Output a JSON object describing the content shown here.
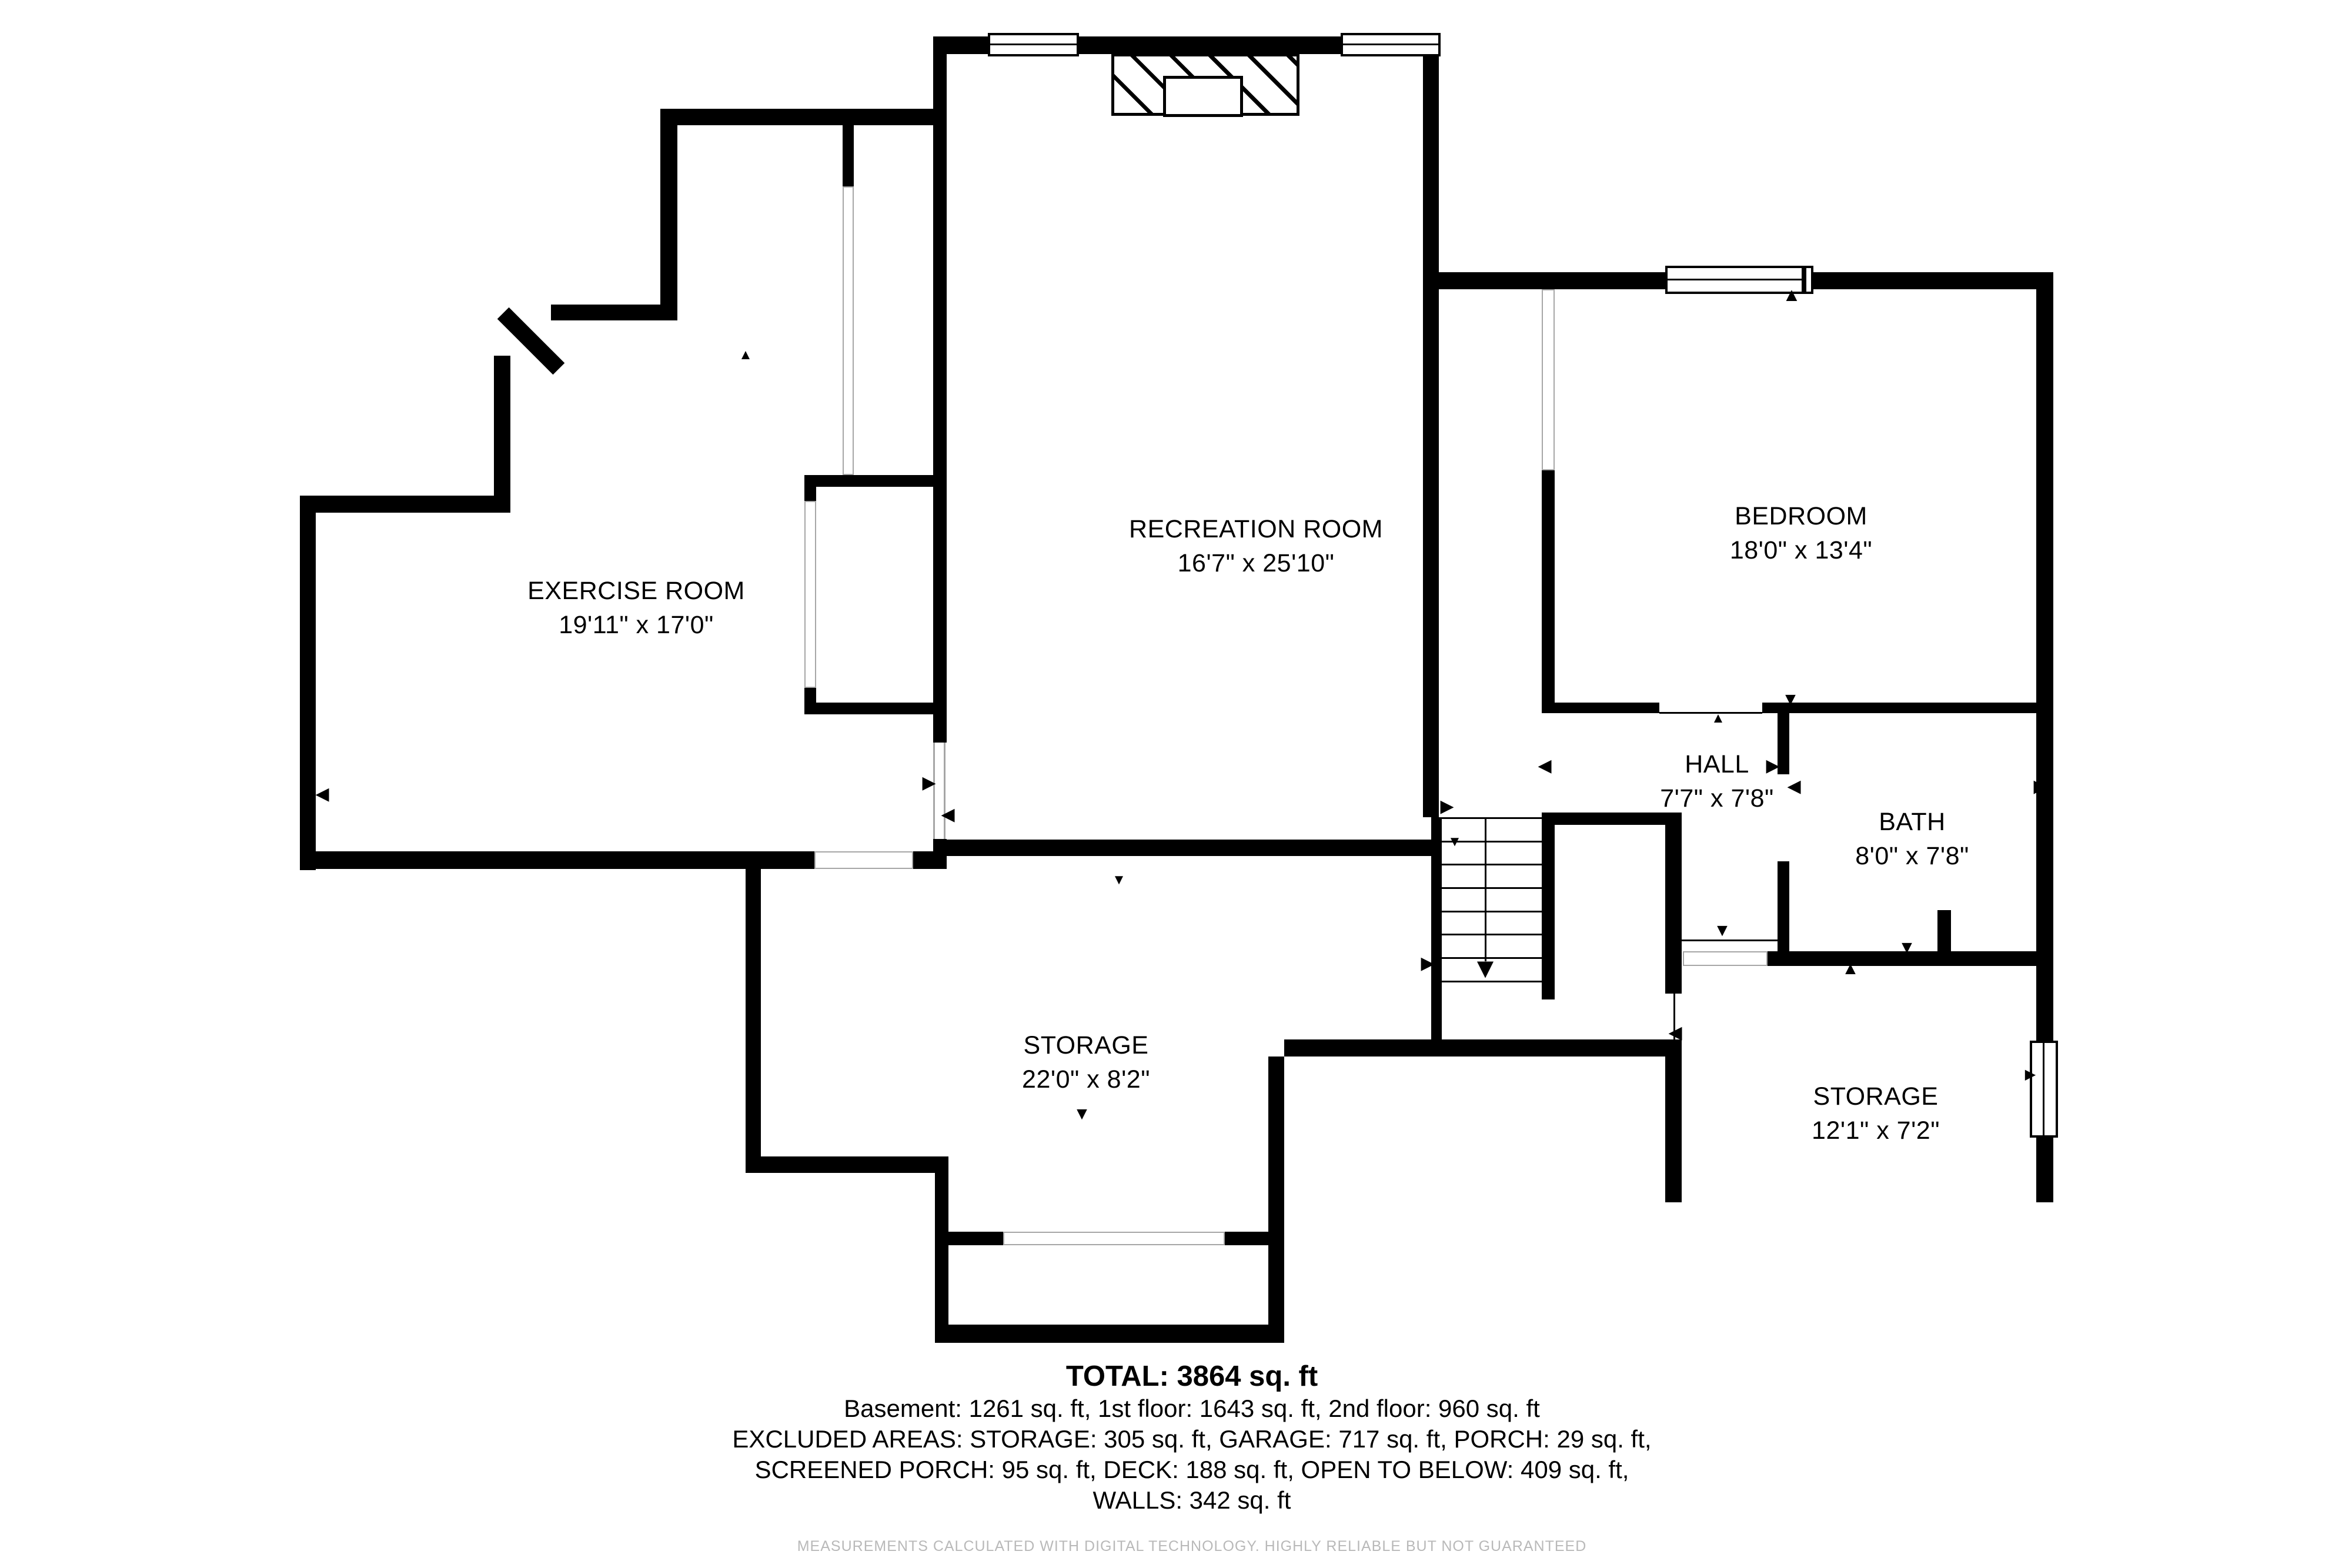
{
  "page": {
    "background": "#ffffff",
    "wall_color": "#000000",
    "thin_line_color": "#a6a6a6",
    "disclaimer_color": "#b9b9b9"
  },
  "rooms": [
    {
      "id": "exercise-room",
      "name": "EXERCISE ROOM",
      "dims": "19'11\" x 17'0\""
    },
    {
      "id": "recreation-room",
      "name": "RECREATION ROOM",
      "dims": "16'7\" x 25'10\""
    },
    {
      "id": "bedroom",
      "name": "BEDROOM",
      "dims": "18'0\" x 13'4\""
    },
    {
      "id": "hall",
      "name": "HALL",
      "dims": "7'7\" x 7'8\""
    },
    {
      "id": "bath",
      "name": "BATH",
      "dims": "8'0\" x 7'8\""
    },
    {
      "id": "storage",
      "name": "STORAGE",
      "dims": "22'0\" x 8'2\""
    },
    {
      "id": "storage-2",
      "name": "STORAGE",
      "dims": "12'1\" x 7'2\""
    }
  ],
  "summary": {
    "total": "TOTAL: 3864 sq. ft",
    "line1": "Basement: 1261 sq. ft, 1st floor: 1643 sq. ft, 2nd floor: 960 sq. ft",
    "line2": "EXCLUDED AREAS: STORAGE: 305 sq. ft, GARAGE: 717 sq. ft, PORCH: 29 sq. ft,",
    "line3": "SCREENED PORCH: 95 sq. ft, DECK: 188 sq. ft, OPEN TO BELOW: 409 sq. ft,",
    "line4": "WALLS: 342 sq. ft"
  },
  "disclaimer": "MEASUREMENTS CALCULATED WITH DIGITAL TECHNOLOGY. HIGHLY RELIABLE BUT NOT GUARANTEED"
}
